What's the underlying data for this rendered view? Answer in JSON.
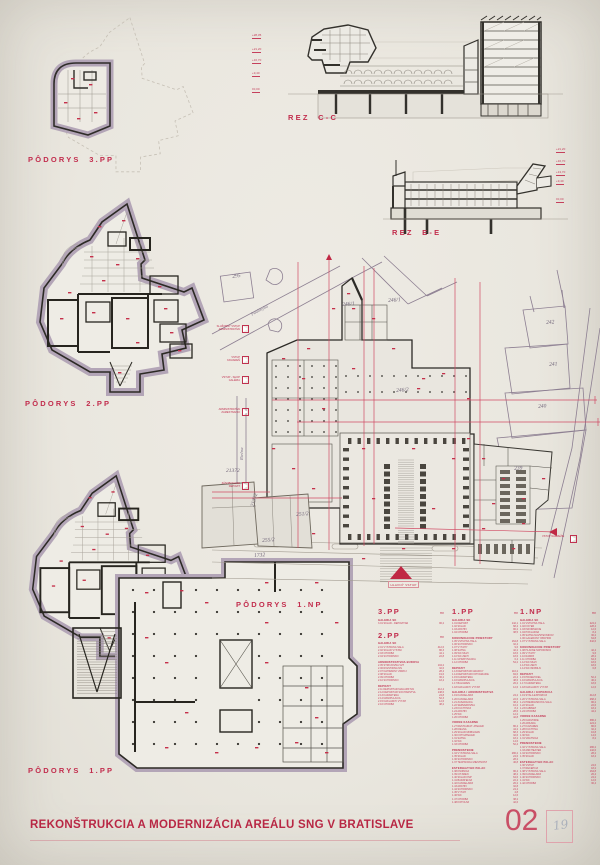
{
  "sheet": {
    "title": "REKONŠTRUKCIA A MODERNIZÁCIA AREÁLU SNG V BRATISLAVE",
    "number": "02",
    "pencil_note": "19"
  },
  "labels": {
    "plan_3pp": "PÔDORYS  3.PP",
    "plan_2pp": "PÔDORYS  2.PP",
    "plan_1pp": "PÔDORYS  1.PP",
    "plan_1np": "PÔDORYS  1.NP",
    "section_cc": "REZ  C-C",
    "section_ee": "REZ  E-E"
  },
  "site": {
    "streets": {
      "paulinyho": "Paulínyho",
      "riecna": "Riečna"
    },
    "parcels": [
      "295",
      "246/1",
      "246/1",
      "246/2",
      "242",
      "241",
      "240",
      "239",
      "21372",
      "21372",
      "251/2",
      "255/2",
      "1732"
    ],
    "entry_labels": [
      "SLUŽOBNÝ VSTUP\nADMINISTRATÍVA",
      "VSTUP\nKAVIAREŇ",
      "VSTUP - SHOP\nGALÉRIA",
      "ADMINISTRATÍVA\nZAMESTNANCI",
      "ZÁSOBOVANIE\nDEPOZIT"
    ],
    "right_entry_label": "VSTUP NÁBREŽIE",
    "main_entry_label": "HLAVNÝ VSTUP"
  },
  "sections": {
    "cc_levels": [
      "+28,35",
      "+21,20",
      "+16,70",
      "+9,40",
      "±0,00"
    ],
    "ee_levels": [
      "+21,20",
      "+16,70",
      "+13,70",
      "+9,40",
      "±0,00"
    ]
  },
  "legend": {
    "unit": "m²",
    "columns": [
      {
        "blocks": [
          {
            "floor": "3.PP",
            "groups": [
              {
                "title": "GALÉRIA SK",
                "rows": [
                  [
                    "3.01",
                    "SKLAD - DEPOZITÁR",
                    "96,2"
                  ]
                ]
              }
            ]
          },
          {
            "floor": "2.PP",
            "groups": [
              {
                "title": "GALÉRIA SK",
                "rows": [
                  [
                    "2.01",
                    "VÝSTAVNÁ SÁLA",
                    "412,6"
                  ],
                  [
                    "2.02",
                    "SKLAD VÝSTAV",
                    "86,3"
                  ],
                  [
                    "2.03",
                    "CHODBA",
                    "44,1"
                  ],
                  [
                    "2.04",
                    "SCHODISKO",
                    "22,8"
                  ]
                ]
              },
              {
                "title": "ADMINISTRATÍVNA BUDOVA",
                "rows": [
                  [
                    "2.05",
                    "STROJOVŇA VZT",
                    "104,2"
                  ],
                  [
                    "2.06",
                    "ROZVODŇA NN",
                    "32,6"
                  ],
                  [
                    "2.07",
                    "NÁHRADNÝ ZDROJ",
                    "28,4"
                  ],
                  [
                    "2.08",
                    "SKLAD",
                    "19,6"
                  ],
                  [
                    "2.09",
                    "CHODBA",
                    "36,2"
                  ],
                  [
                    "2.10",
                    "SCHODISKO",
                    "18,4"
                  ]
                ]
              },
              {
                "title": "DEPOZIT",
                "rows": [
                  [
                    "2.11",
                    "DEPOZITÁR MALIARSTVA",
                    "212,4"
                  ],
                  [
                    "2.12",
                    "DEPOZITÁR SOCHÁRSTVA",
                    "148,6"
                  ],
                  [
                    "2.13",
                    "KARANTÉNA",
                    "24,8"
                  ],
                  [
                    "2.14",
                    "MANIPULÁCIA",
                    "52,3"
                  ],
                  [
                    "2.15",
                    "NÁKLADNÝ VÝŤAH",
                    "12,6"
                  ],
                  [
                    "2.16",
                    "CHODBA",
                    "48,2"
                  ]
                ]
              }
            ]
          }
        ]
      },
      {
        "blocks": [
          {
            "floor": "1.PP",
            "groups": [
              {
                "title": "GALÉRIA SK",
                "rows": [
                  [
                    "1.01",
                    "DEPOZIT",
                    "142,1"
                  ],
                  [
                    "1.02",
                    "SKLAD",
                    "68,4"
                  ],
                  [
                    "1.03",
                    "ARCHÍV",
                    "96,2"
                  ],
                  [
                    "1.04",
                    "CHODBA",
                    "38,5"
                  ]
                ]
              },
              {
                "title": "KOMUNIKAČNÉ PRIESTORY",
                "rows": [
                  [
                    "1.05",
                    "VSTUPNÁ HALA",
                    "164,8"
                  ],
                  [
                    "1.06",
                    "SCHODISKO",
                    "32,4"
                  ],
                  [
                    "1.07",
                    "VÝŤAHY",
                    "9,6"
                  ],
                  [
                    "1.08",
                    "ŠATŇA",
                    "42,2"
                  ],
                  [
                    "1.09",
                    "WC MUŽI",
                    "18,6"
                  ],
                  [
                    "1.10",
                    "WC ŽENY",
                    "18,6"
                  ],
                  [
                    "1.11",
                    "UPRATOVAČKA",
                    "6,4"
                  ],
                  [
                    "1.12",
                    "CHODBA",
                    "54,2"
                  ]
                ]
              },
              {
                "title": "DEPOZIT",
                "rows": [
                  [
                    "1.13",
                    "DEPOZITÁR GRAFIKY",
                    "116,2"
                  ],
                  [
                    "1.14",
                    "DEPOZITÁR FOTOGRAFIE",
                    "84,6"
                  ],
                  [
                    "1.15",
                    "KARANTÉNA",
                    "22,4"
                  ],
                  [
                    "1.16",
                    "MANIPULÁCIA",
                    "48,6"
                  ],
                  [
                    "1.17",
                    "BALIAREŇ",
                    "26,2"
                  ],
                  [
                    "1.18",
                    "NÁKLADNÝ VÝŤAH",
                    "12,6"
                  ]
                ]
              },
              {
                "title": "GALÉRIA / ADMINISTRATÍVA",
                "rows": [
                  [
                    "1.19",
                    "KANCELÁRIA",
                    "24,2"
                  ],
                  [
                    "1.20",
                    "KANCELÁRIA",
                    "22,6"
                  ],
                  [
                    "1.21",
                    "ZASADAČKA",
                    "38,4"
                  ],
                  [
                    "1.22",
                    "SERVEROVŇA",
                    "16,2"
                  ],
                  [
                    "1.23",
                    "KUCHYNKA",
                    "8,4"
                  ],
                  [
                    "1.24",
                    "ARCHÍV",
                    "28,6"
                  ],
                  [
                    "1.25",
                    "WC",
                    "12,2"
                  ],
                  [
                    "1.26",
                    "CHODBA",
                    "42,8"
                  ]
                ]
              },
              {
                "title": "VODNÉ KASÁRNE",
                "rows": [
                  [
                    "1.27",
                    "REŠTAURÁT. ATELIÉR",
                    "86,4"
                  ],
                  [
                    "1.28",
                    "DIELŇA",
                    "44,2"
                  ],
                  [
                    "1.29",
                    "SKLAD MOBILIÁRU",
                    "68,3"
                  ],
                  [
                    "1.30",
                    "FOTOATELIÉR",
                    "32,6"
                  ],
                  [
                    "1.31",
                    "ŠATŇA",
                    "18,2"
                  ],
                  [
                    "1.32",
                    "WC",
                    "14,6"
                  ],
                  [
                    "1.33",
                    "CHODBA",
                    "52,4"
                  ]
                ]
              },
              {
                "title": "PREMOSTENIE",
                "rows": [
                  [
                    "1.34",
                    "VÝSTAVNÁ SÁLA",
                    "286,2"
                  ],
                  [
                    "1.35",
                    "SKLAD",
                    "24,6"
                  ],
                  [
                    "1.36",
                    "SCHODISKO",
                    "28,2"
                  ],
                  [
                    "1.37",
                    "TECHNICKÁ MIESTNOSŤ",
                    "46,8"
                  ]
                ]
              },
              {
                "title": "ESTERHÁZYHO PALÁC",
                "rows": [
                  [
                    "1.38",
                    "KNIŽNICA",
                    "96,4"
                  ],
                  [
                    "1.39",
                    "ČITÁREŇ",
                    "48,2"
                  ],
                  [
                    "1.40",
                    "SKLAD KNÍH",
                    "64,6"
                  ],
                  [
                    "1.41",
                    "BÁDATEĽŇA",
                    "22,4"
                  ],
                  [
                    "1.42",
                    "KANCELÁRIA",
                    "26,2"
                  ],
                  [
                    "1.43",
                    "ARCHÍV",
                    "32,8"
                  ],
                  [
                    "1.44",
                    "SCHODISKO",
                    "24,4"
                  ],
                  [
                    "1.45",
                    "VÝŤAH",
                    "4,8"
                  ],
                  [
                    "1.46",
                    "WC",
                    "12,6"
                  ],
                  [
                    "1.47",
                    "CHODBA",
                    "38,2"
                  ],
                  [
                    "1.48",
                    "KOTOLŇA",
                    "42,6"
                  ]
                ]
              }
            ]
          }
        ]
      },
      {
        "blocks": [
          {
            "floor": "1.NP",
            "groups": [
              {
                "title": "GALÉRIA SK",
                "rows": [
                  [
                    "1.01",
                    "VSTUPNÁ HALA",
                    "224,2"
                  ],
                  [
                    "1.02",
                    "FOYER",
                    "128,4"
                  ],
                  [
                    "1.03",
                    "INFORMÁCIE",
                    "12,6"
                  ],
                  [
                    "1.04",
                    "POKLADŇA",
                    "8,4"
                  ],
                  [
                    "1.05",
                    "ŠATŇA NÁVŠTEVNÍKOV",
                    "36,2"
                  ],
                  [
                    "1.06",
                    "GALERIJNÝ OBCHOD",
                    "64,8"
                  ],
                  [
                    "1.07",
                    "VÝSTAVNÁ SÁLA",
                    "342,6"
                  ]
                ]
              },
              {
                "title": "KOMUNIKAČNÉ PRIESTORY",
                "rows": [
                  [
                    "1.08",
                    "HLAVNÉ SCHODISKO",
                    "42,4"
                  ],
                  [
                    "1.09",
                    "VÝŤAHY",
                    "9,6"
                  ],
                  [
                    "1.10",
                    "RAMPA",
                    "28,2"
                  ],
                  [
                    "1.11",
                    "CHODBA",
                    "64,3"
                  ],
                  [
                    "1.12",
                    "WC MUŽI",
                    "18,6"
                  ],
                  [
                    "1.13",
                    "WC ŽENY",
                    "18,6"
                  ],
                  [
                    "1.14",
                    "WC IMOBILNÍ",
                    "6,8"
                  ]
                ]
              },
              {
                "title": "DEPOZIT",
                "rows": [
                  [
                    "1.15",
                    "PRÍJEM DIEL",
                    "52,4"
                  ],
                  [
                    "1.16",
                    "MANIPULÁCIA",
                    "46,2"
                  ],
                  [
                    "1.17",
                    "KARANTÉNA",
                    "18,6"
                  ],
                  [
                    "1.18",
                    "NÁKLADNÝ VÝŤAH",
                    "12,6"
                  ]
                ]
              },
              {
                "title": "GALÉRIA / EXPOZÍCIA",
                "rows": [
                  [
                    "1.19",
                    "STÁLA EXPOZÍCIA",
                    "412,8"
                  ],
                  [
                    "1.20",
                    "VÝSTAVNÁ SÁLA",
                    "268,4"
                  ],
                  [
                    "1.21",
                    "PREDNÁŠKOVÁ SÁLA",
                    "96,2"
                  ],
                  [
                    "1.22",
                    "SKLAD",
                    "22,6"
                  ],
                  [
                    "1.23",
                    "KABINET",
                    "18,4"
                  ],
                  [
                    "1.24",
                    "CHODBA",
                    "44,2"
                  ]
                ]
              },
              {
                "title": "VODNÉ KASÁRNE",
                "rows": [
                  [
                    "1.25",
                    "NÁDVORIE",
                    "386,4"
                  ],
                  [
                    "1.26",
                    "ARKÁDA",
                    "124,2"
                  ],
                  [
                    "1.27",
                    "KAVIAREŇ",
                    "86,6"
                  ],
                  [
                    "1.28",
                    "KUCHYŇA",
                    "32,4"
                  ],
                  [
                    "1.29",
                    "SKLAD",
                    "16,8"
                  ],
                  [
                    "1.30",
                    "WC",
                    "14,6"
                  ],
                  [
                    "1.31",
                    "VRÁTNICA",
                    "8,2"
                  ]
                ]
              },
              {
                "title": "PREMOSTENIE",
                "rows": [
                  [
                    "1.32",
                    "VÝSTAVNÁ SÁLA",
                    "286,2"
                  ],
                  [
                    "1.33",
                    "AMFITEÁTER",
                    "142,6"
                  ],
                  [
                    "1.34",
                    "SCHODISKO",
                    "28,2"
                  ],
                  [
                    "1.35",
                    "SKLAD",
                    "18,4"
                  ]
                ]
              },
              {
                "title": "ESTERHÁZYHO PALÁC",
                "rows": [
                  [
                    "1.36",
                    "VSTUP",
                    "24,6"
                  ],
                  [
                    "1.37",
                    "RECEPCIA",
                    "18,2"
                  ],
                  [
                    "1.38",
                    "VÝSTAVNÁ SÁLA",
                    "164,8"
                  ],
                  [
                    "1.39",
                    "KANCELÁRIA",
                    "26,4"
                  ],
                  [
                    "1.40",
                    "SCHODISKO",
                    "24,2"
                  ],
                  [
                    "1.41",
                    "WC",
                    "12,6"
                  ],
                  [
                    "1.42",
                    "CHODBA",
                    "36,4"
                  ]
                ]
              }
            ]
          }
        ]
      }
    ]
  }
}
